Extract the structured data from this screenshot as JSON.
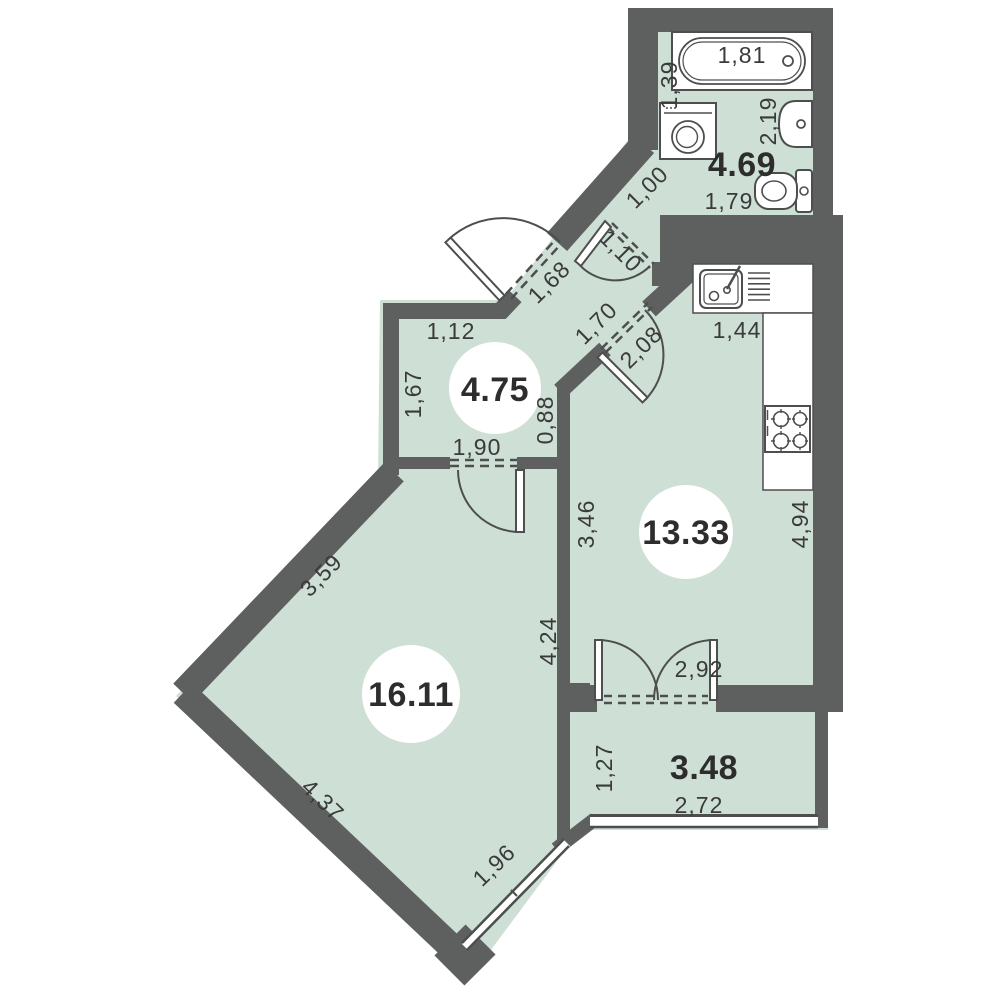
{
  "colors": {
    "floor": "#cedfd5",
    "wall": "#5d605f",
    "fixture_outline": "#4d4f4e",
    "dimension_text": "#3a3a3a",
    "area_text": "#2d2d2d"
  },
  "rooms": [
    {
      "key": "bathroom",
      "area": "4.69",
      "dims": {
        "bathtub": "1,81",
        "side": "1,39",
        "sink_wall": "2,19",
        "toilet_wall": "1,79",
        "entry_corridor": "1,00",
        "door": "1,10"
      },
      "fixtures": [
        "bathtub",
        "washing-machine",
        "sink",
        "toilet"
      ]
    },
    {
      "key": "hallway",
      "area": "4.75",
      "dims": {
        "top": "1,12",
        "left": "1,67",
        "right": "0,88",
        "room_door": "1,90",
        "entrance_door": "1,68"
      },
      "fixtures": []
    },
    {
      "key": "kitchen",
      "area": "13.33",
      "dims": {
        "counter": "1,44",
        "right": "4,94",
        "left": "3,46",
        "door_opening": "1,70",
        "door": "2,08",
        "balcony_door": "2,92"
      },
      "fixtures": [
        "sink",
        "stove"
      ]
    },
    {
      "key": "living-room",
      "area": "16.11",
      "dims": {
        "upper_left": "3,59",
        "lower_left": "4,37",
        "right": "4,24",
        "window": "1,96"
      },
      "fixtures": []
    },
    {
      "key": "balcony",
      "area": "3.48",
      "dims": {
        "left": "1,27",
        "bottom": "2,72"
      },
      "fixtures": []
    }
  ]
}
